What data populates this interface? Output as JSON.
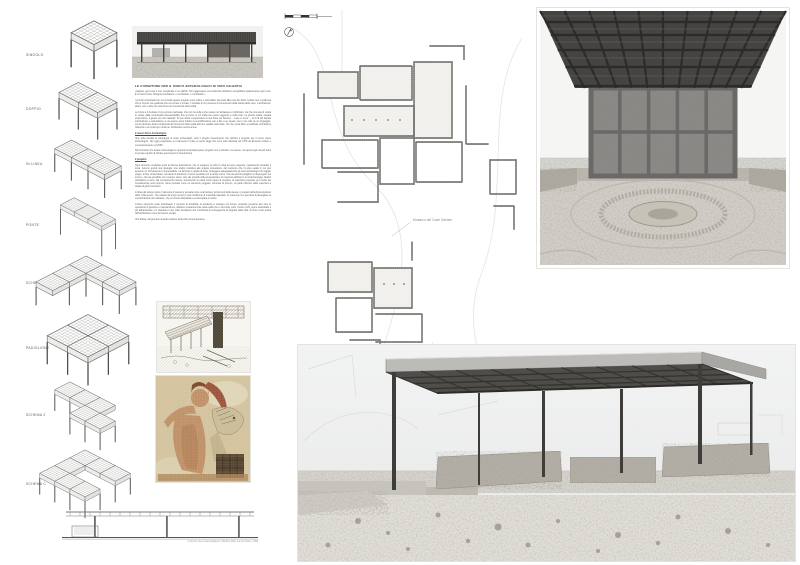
{
  "colors": {
    "paper": "#ffffff",
    "roof_dark": "#4f4d49",
    "plan_wall": "#6a6a66",
    "mosaic_tan": "#d8c7a2",
    "mosaic_red": "#94402a",
    "mosaic_skin": "#c08a60"
  },
  "schemes": {
    "items": [
      {
        "label": "SINGOLO",
        "cells": [
          [
            0,
            0
          ]
        ],
        "legs": [
          [
            0,
            1
          ],
          [
            1,
            1
          ],
          [
            1,
            0
          ]
        ],
        "leg_h": 0.55
      },
      {
        "label": "DOPPIO",
        "cells": [
          [
            0,
            0
          ],
          [
            1,
            0
          ]
        ],
        "legs": [
          [
            0,
            1
          ],
          [
            1,
            1
          ],
          [
            2,
            1
          ],
          [
            2,
            0
          ]
        ],
        "leg_h": 0.5
      },
      {
        "label": "IN LINEA",
        "cells": [
          [
            0,
            0
          ],
          [
            1,
            0
          ],
          [
            2,
            0
          ]
        ],
        "legs": [
          [
            0,
            1
          ],
          [
            1,
            1
          ],
          [
            2,
            1
          ],
          [
            3,
            1
          ],
          [
            3,
            0
          ]
        ],
        "leg_h": 0.5
      },
      {
        "label": "PONTE",
        "cells": [
          [
            0,
            0
          ],
          [
            1,
            0
          ],
          [
            2,
            0
          ]
        ],
        "legs": [
          [
            0,
            1
          ],
          [
            3,
            1
          ],
          [
            3,
            0
          ]
        ],
        "leg_h": 0.85
      },
      {
        "label": "SCHEMA L",
        "cells": [
          [
            0,
            0
          ],
          [
            1,
            0
          ],
          [
            2,
            0
          ],
          [
            0,
            1
          ],
          [
            0,
            2
          ]
        ],
        "legs": [
          [
            1,
            2
          ],
          [
            0,
            3
          ],
          [
            1,
            1
          ],
          [
            2,
            1
          ],
          [
            3,
            1
          ],
          [
            3,
            0
          ]
        ],
        "leg_h": 0.5
      },
      {
        "label": "PADIGLIONE",
        "cells": [
          [
            0,
            0
          ],
          [
            1,
            0
          ],
          [
            0,
            1
          ],
          [
            1,
            1
          ]
        ],
        "legs": [
          [
            0,
            2
          ],
          [
            1,
            2
          ],
          [
            2,
            2
          ],
          [
            2,
            1
          ],
          [
            2,
            0
          ]
        ],
        "leg_h": 0.5
      },
      {
        "label": "SCHEMA 2",
        "cells": [
          [
            0,
            0
          ],
          [
            1,
            0
          ],
          [
            2,
            0
          ],
          [
            2,
            1
          ],
          [
            3,
            1
          ]
        ],
        "legs": [
          [
            0,
            1
          ],
          [
            1,
            1
          ],
          [
            2,
            2
          ],
          [
            3,
            2
          ],
          [
            4,
            2
          ],
          [
            4,
            1
          ]
        ],
        "leg_h": 0.5
      },
      {
        "label": "SCHEMA C",
        "cells": [
          [
            0,
            0
          ],
          [
            1,
            0
          ],
          [
            2,
            0
          ],
          [
            0,
            1
          ],
          [
            0,
            2
          ],
          [
            1,
            2
          ],
          [
            2,
            2
          ]
        ],
        "legs": [
          [
            0,
            3
          ],
          [
            1,
            3
          ],
          [
            2,
            3
          ],
          [
            3,
            3
          ],
          [
            3,
            2
          ],
          [
            3,
            1
          ],
          [
            3,
            0
          ]
        ],
        "leg_h": 0.5
      }
    ]
  },
  "section": {
    "caption": "confronto: Neue Nationalgalerie di Berlino (Mies van der Rohe), 1968"
  },
  "essay": {
    "title": "LE COPERTURE PER IL PARCO ARCHEOLOGICO DI VIBO VALENTIA",
    "quote": "«Sapete, ogni cosa è così complicata in un edificio. Per raggiungere una chiarezza dobbiamo semplificare praticamente ogni cosa. È un lavoro duro. Bisogna combattere, e combattere, e combattere.»",
    "p1": "I principi concettuali con cui si fonda questo progetto sono ordine e razionalità. Secondo Mies van der Rohe l'ordine non è qualcosa che si impone ma qualcosa che va cercato e trovato, il risultato di un processo di conoscenza della natura delle cose. L'architettura, allora, non è altro che una forma di conoscenza della realtà.",
    "p2": "La forma è il risultato di un percorso razionale, che non ha nulla a che vedere col fantasioso o l'arbitrario, ma che procede di scelta in scelta, dalla complessità all'essenzialità, fino al punto in cui nulla può essere aggiunto e nulla tolto. La misura esatta, l'esatta proporzione, il giusto uso dei materiali. Si può allora comprendere la sua frase più famosa – “Less is more” – al di là del banale minimalismo e razionalismo a cui spesso viene ridotta: la semplificazione non è fine a se stessa, non è uno stile né un linguaggio, ma la riduzione della complessità dei fenomeni della realtà alla loro qualità essenziale. Ciò che porta Mies a realizzare architetture classiche e al contempo moderne. Architetture senza tempo.",
    "s1_title": "Il nuovo Parco Archeologico",
    "s1_p1": "Una volta avviata la campagna di scavi archeologici, sarà il singolo rinvenimento che definirà il progetto per il nuovo parco archeologico. Noi oggi progettiamo un intervento in base ai pochi saggi che sono stati effettuati nel 1970 da Ermanno Arslan e successivamente nel 2005.",
    "s1_p2": "Dal momento che la fase archeologica è appena cominciata questo progetto non si chiude in se stesso, ma aperto agli scenari futuri si presta a quello di iniziare quest'opera di ricostruzione.",
    "s2_title": "Il progetto",
    "s2_p1": "Ogni elemento modulare gode di diverse declinazioni, che si scelgono di volta in volta ad ogni esigenza, mantenendo invariato il tema. Avremo quindi una tipologia: una analisi risolutiva alle singole circostanze, dal momento che il punto esatto in cui può avvenire un ritrovamento è imprevedibile. La funzione è quella di dover proteggere adeguatamente gli scavi archeologici di maggior pregio, al fine conservativo, cercando di interferire il meno possibile con il campo visivo. Che dei piccoli padiglioni si dispongano sul terreno, che sia possibile con il campo visivo, sino dei prodotti della progettazione di copertura all'interno di un'archeologia; l'anello nell'attacco a terra, dal concepimento stesso. Assumendo la tutela come figura di progetto, la copertura proposta, per merito del considerevole peso proprio, viene pensata come un elemento poggiato, ancorato al terreno. La parte inferiore della copertura è dotata di grubo luminoso.",
    "s2_p2": "A l'idea del campo visivo, l'elemento di parete si pensata come una barriera, ferma fuori dalla stessa, i prospetti dell'edicola piuttosto della “città nuova”, che variano da tempi remoti in una condizione di meticciato degrado; al contempo non permette di dissogliare la concentrazione del visitatore, che si ritrova indisturbato a contemplare le rovine.",
    "s2_p3": "L'intero elemento vuole sottolineare il concetto di durabilità, la tendenza a resistere nel tempo, portando prossime allo zero le operazioni di gestione e manutenzione; abbiamo costantemente nella realtà che ci circonda, sotto i nostri occhi, opere inascoltate e poi abbandonate e si distende in uno stato decadente che contribuirà di conseguenza al degrado della città. Si tiene conto quindi dell'architettura come fenomeno sociale.",
    "closing": "Una difesa, dal perenne assedio estetico della città contemporanea."
  },
  "plan": {
    "labels": [
      {
        "text": "Mosaico del Case Gerden"
      },
      {
        "text": "Mosaico delle Quattro Stagioni"
      }
    ]
  }
}
